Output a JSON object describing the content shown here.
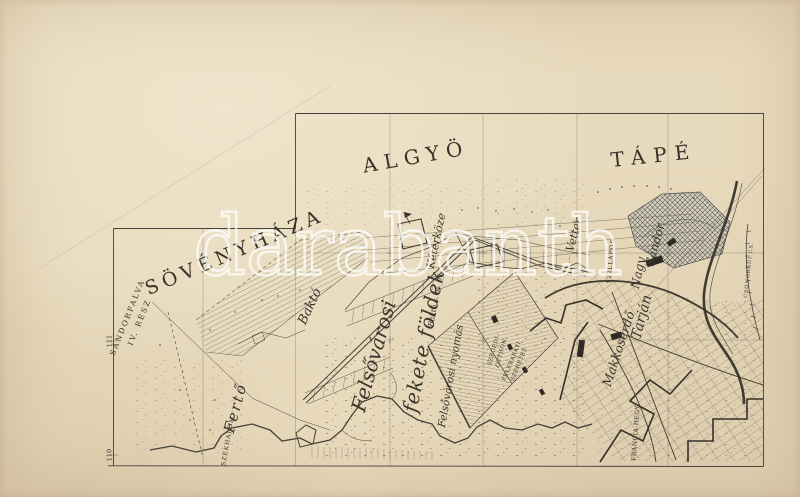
{
  "artifact": {
    "kind": "antique cadastral map sheet photograph",
    "region": "Szeged surroundings"
  },
  "colors": {
    "paper": "#e8dabc",
    "ink": "#45403a",
    "water_line": "#38342b",
    "crosshatch_tint": "#4d5460",
    "watermark": "#ffffff"
  },
  "watermark": {
    "text": "darabanth"
  },
  "labels": {
    "sovenyhaza": "SÖVÉNYHÁZA",
    "algyo": "ALGYÖ",
    "tape": "TÁPÉ",
    "sandorfalva1": "SÁNDORFALVA",
    "sandorfalva2": "IV. RÉSZ",
    "ferto": "Fertő",
    "bakto": "Baktó",
    "felsovarosi": "Felsővárosi",
    "fekete_foldek": "fekete földek",
    "felsovarosi_nyomas": "Felsővárosi nyomás",
    "bakto_sm": "Baktó s. m. 6.",
    "keterkoze": "Kétérköze",
    "vetter": "Vetter",
    "nagy": "Nagy",
    "sandor": "Sándor",
    "szillapos": "SZILLAPOS",
    "tarjan": "Tarján",
    "makkoserdo": "Makkoserdő",
    "szekhalom": "SZÉKHALOM",
    "szegedi1": "SZEGEDI",
    "szegedi2": "OTTHON",
    "felebarati1": "FELEBARÁTI",
    "felebarati2": "SZERETET",
    "francia_hegy": "FRANCIA-HEGY",
    "csongradi": "CSONGRÁDI CS.",
    "grid_111": "111",
    "grid_110": "110"
  }
}
